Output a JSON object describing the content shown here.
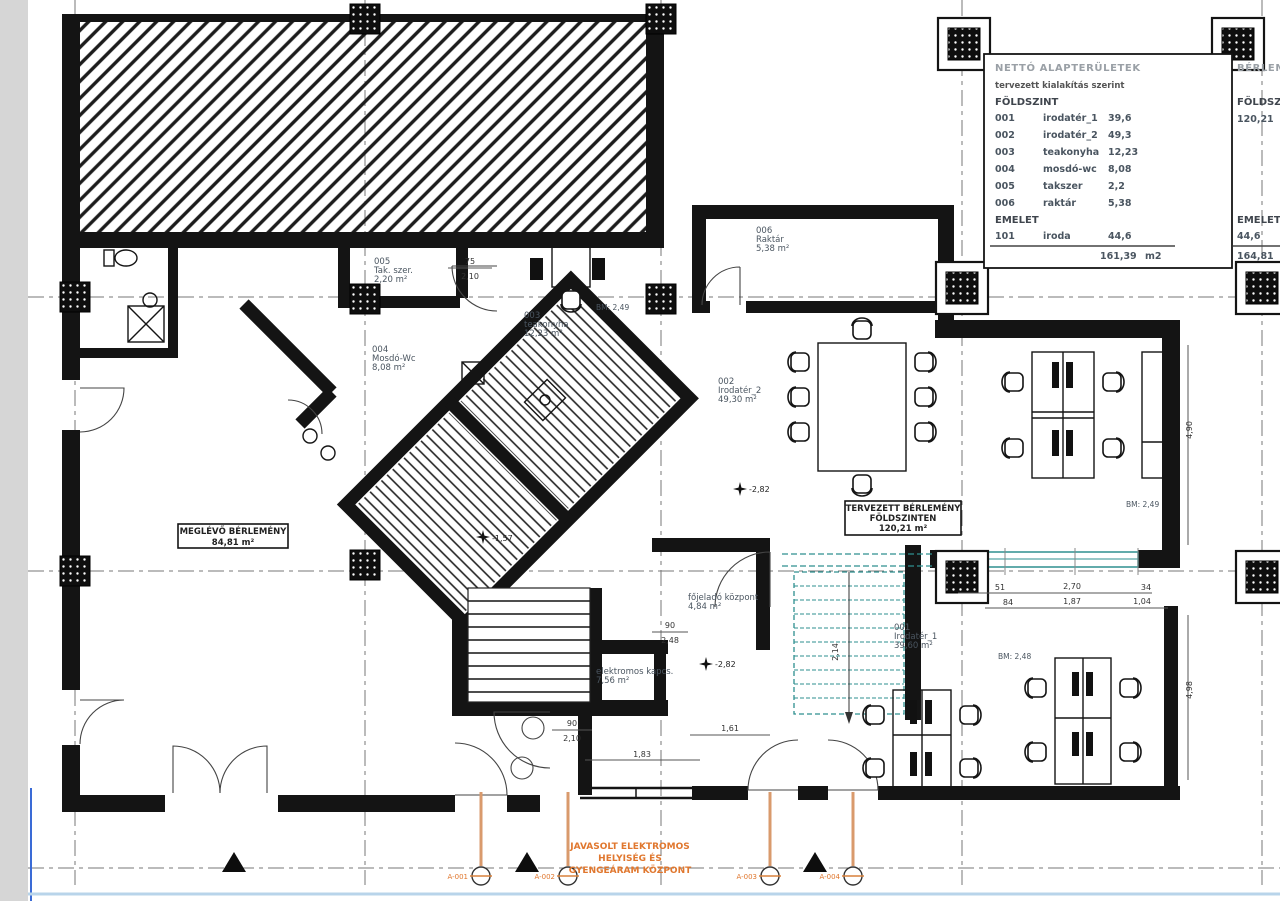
{
  "schedule": {
    "title": "NETTÓ ALAPTERÜLETEK",
    "subtitle": "tervezett kialakítás szerint",
    "ground_header": "FÖLDSZINT",
    "rows": [
      {
        "num": "001",
        "name": "irodatér_1",
        "value": "39,6"
      },
      {
        "num": "002",
        "name": "irodatér_2",
        "value": "49,3"
      },
      {
        "num": "003",
        "name": "teakonyha",
        "value": "12,23"
      },
      {
        "num": "004",
        "name": "mosdó-wc",
        "value": "8,08"
      },
      {
        "num": "005",
        "name": "takszer",
        "value": "2,2"
      },
      {
        "num": "006",
        "name": "raktár",
        "value": "5,38"
      }
    ],
    "upper_header": "EMELET",
    "upper_row": {
      "num": "101",
      "name": "iroda",
      "value": "44,6"
    },
    "total_value": "161,39",
    "total_unit": "m2"
  },
  "rental": {
    "title": "BÉRLEMÉNY",
    "ground_label": "FÖLDSZINT",
    "ground_value": "120,21",
    "upper_label": "EMELET",
    "upper_value": "44,6",
    "total": "164,81"
  },
  "rooms": {
    "r001": {
      "id": "001",
      "name": "Irodatér_1",
      "area": "39,60 m²"
    },
    "r002": {
      "id": "002",
      "name": "Irodatér_2",
      "area": "49,30 m²"
    },
    "r003": {
      "id": "003",
      "name": "teakonyha",
      "area": "12,23 m²"
    },
    "r004": {
      "id": "004",
      "name": "Mosdó-Wc",
      "area": "8,08 m²"
    },
    "r005": {
      "id": "005",
      "name": "Tak. szer.",
      "area": "2,20 m²"
    },
    "r006": {
      "id": "006",
      "name": "Raktár",
      "area": "5,38 m²"
    },
    "fojelado": {
      "name": "főjeladó központ",
      "area": "4,84 m²"
    },
    "elektromos": {
      "name": "elektromos kapcs.",
      "area": "7,56 m²"
    }
  },
  "tags": {
    "existing": {
      "line1": "MEGLÉVŐ BÉRLEMÉNY",
      "line2": "84,81 m²"
    },
    "planned": {
      "line1": "TERVEZETT BÉRLEMÉNY",
      "line2": "FÖLDSZINTEN",
      "line3": "120,21 m²"
    }
  },
  "notes": {
    "electric": [
      "JAVASOLT ELEKTROMOS",
      "HELYISÉG ÉS",
      "GYENGEÁRAM KÖZPONT"
    ]
  },
  "levels": {
    "l1": "-1,57",
    "l2": "-2,82",
    "l3": "-2,82"
  },
  "bm": {
    "b1": "BM: 2,49",
    "b2": "BM: 2,49",
    "b3": "BM: 2,48"
  },
  "dims": {
    "door005_w": "75",
    "door005_h": "2,10",
    "doorMid_w": "90",
    "doorMid_h": "2,10",
    "doorStair_w": "90",
    "doorStair_h": "2,48",
    "run1": [
      "51",
      "2,70",
      "34"
    ],
    "run2": [
      "84",
      "1,87",
      "1,04"
    ],
    "b1": "1,83",
    "b2": "1,61",
    "v1": "4,90",
    "v2": "4,98",
    "stair_w": "2,14"
  },
  "marks": [
    "A-001",
    "A-002",
    "A-003",
    "A-004"
  ],
  "colors": {
    "accent_orange": "#e0772e",
    "accent_teal": "#2e8f8f",
    "accent_blue": "#3a6bd6"
  }
}
